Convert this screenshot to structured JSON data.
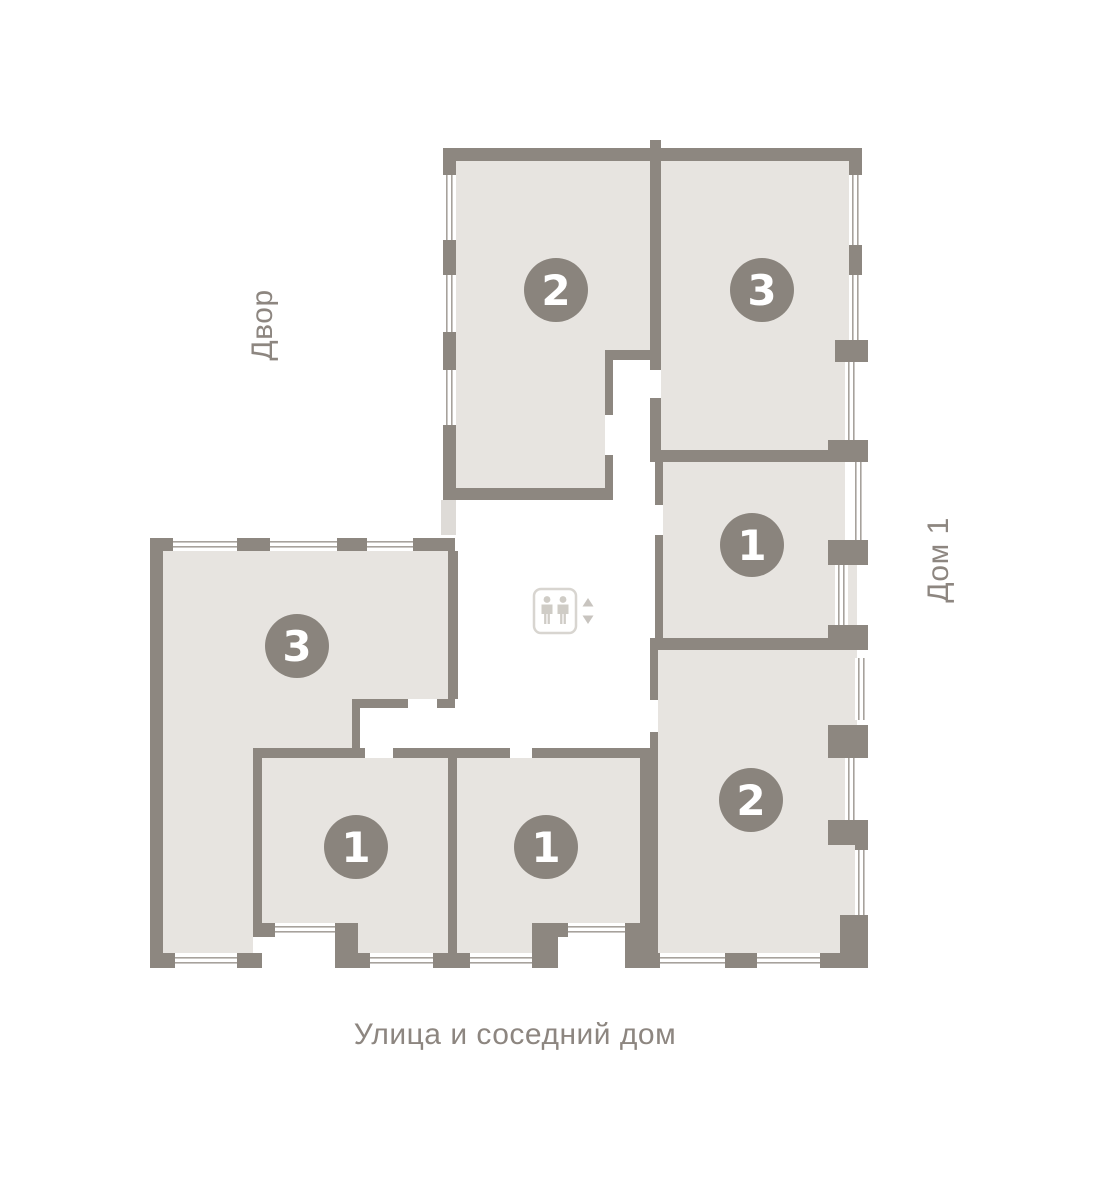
{
  "plan": {
    "labels": {
      "courtyard": "Двор",
      "house": "Дом 1",
      "street": "Улица и соседний дом"
    },
    "apartments": [
      {
        "key": "apartment-2-top",
        "rooms": "2"
      },
      {
        "key": "apartment-3-top-right",
        "rooms": "3"
      },
      {
        "key": "apartment-1-mid-right",
        "rooms": "1"
      },
      {
        "key": "apartment-2-bottom-right",
        "rooms": "2"
      },
      {
        "key": "apartment-3-left",
        "rooms": "3"
      },
      {
        "key": "apartment-1-bottom-left",
        "rooms": "1"
      },
      {
        "key": "apartment-1-bottom-middle",
        "rooms": "1"
      }
    ],
    "elevator": {
      "icon": "elevator-icon"
    },
    "colors": {
      "background": "#ffffff",
      "wall": "#8d8780",
      "room_fill": "#e7e4e0",
      "badge": "#8a847d",
      "badge_number": "#ffffff",
      "window_line": "#a7a29c",
      "label_text": "#8d8680"
    }
  }
}
